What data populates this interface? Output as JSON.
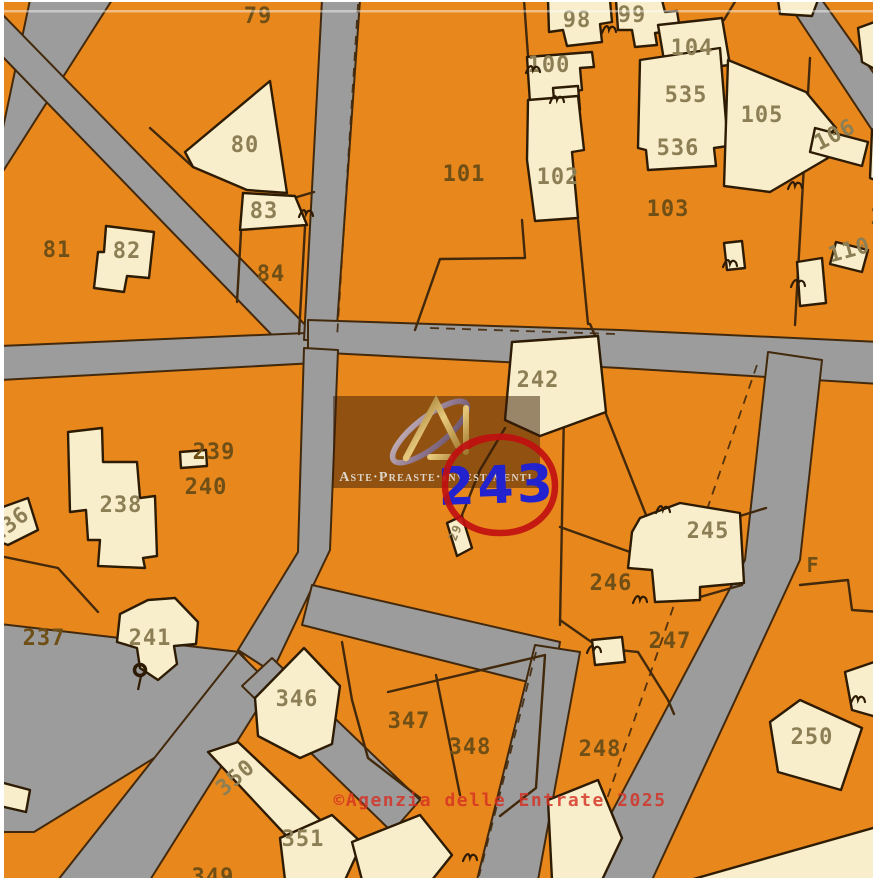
{
  "map": {
    "colors": {
      "parcel_orange": "#E8871C",
      "building_cream": "#F8EECB",
      "road_gray": "#9C9C9C",
      "outline_dark": "#43290C",
      "building_outline": "#2E1B04",
      "label_dark": "#6f4f16",
      "label_light": "#8d7f55",
      "highlight_blue": "#2222CF",
      "highlight_red": "#C01010",
      "copyright_red": "#D53022"
    },
    "watermark": {
      "brand": "Aste·Preaste·Investimenti"
    },
    "highlight": {
      "parcel": "243"
    },
    "copyright": "©Agenzia delle Entrate 2025",
    "roads": [
      {
        "id": "road-topleft-a",
        "pts": "30,0 112,0 0,176 0,142"
      },
      {
        "id": "road-topleft-b",
        "pts": "0,12 318,338 296,360 0,54"
      },
      {
        "id": "road-left-mid",
        "pts": "0,346 330,332 334,362 0,380"
      },
      {
        "id": "road-top-vertical",
        "pts": "322,0 360,0 336,340 304,340"
      },
      {
        "id": "road-central",
        "pts": "308,320 620,330 880,342 880,384 620,368 308,352"
      },
      {
        "id": "road-right-diagonal",
        "pts": "768,352 822,360 800,560 652,880 576,880 745,560"
      },
      {
        "id": "road-center-left",
        "pts": "304,348 338,350 330,550 272,672 238,650 298,552"
      },
      {
        "id": "road-west-arm",
        "pts": "0,624 240,652 268,688 34,832 0,832"
      },
      {
        "id": "road-south-arm",
        "pts": "238,652 272,686 150,880 58,880"
      },
      {
        "id": "road-southeast-arm",
        "pts": "242,686 272,658 420,800 392,832"
      },
      {
        "id": "road-bottom-mid",
        "pts": "312,585 560,642 552,688 302,625"
      },
      {
        "id": "road-bottom-vertical",
        "pts": "535,645 580,652 538,880 477,880"
      },
      {
        "id": "road-topright",
        "pts": "786,0 822,0 880,82 880,142"
      }
    ],
    "buildings": [
      {
        "id": "bldg-80",
        "pts": "270,81 287,193 247,190 193,167 185,152"
      },
      {
        "id": "bldg-83",
        "pts": "243,193 295,196 307,225 240,230"
      },
      {
        "id": "bldg-82",
        "pts": "106,226 154,232 149,278 127,276 124,292 94,288 98,252 104,252"
      },
      {
        "id": "bldg-98",
        "pts": "548,0 610,0 612,22 600,24 602,42 567,46 563,30 549,32"
      },
      {
        "id": "bldg-99",
        "pts": "616,0 662,0 665,12 677,11 680,30 655,33 657,45 635,47 632,30 618,30"
      },
      {
        "id": "bldg-100",
        "pts": "527,57 592,52 594,67 580,68 582,90 570,92 572,100 530,103"
      },
      {
        "id": "bldg-100-annex",
        "pts": "553,88 578,86 580,110 555,112"
      },
      {
        "id": "bldg-102",
        "pts": "528,100 578,96 584,150 572,152 578,218 535,221 527,160"
      },
      {
        "id": "bldg-104",
        "pts": "658,25 722,18 730,65 666,72"
      },
      {
        "id": "bldg-535",
        "pts": "640,60 720,48 728,146 714,148 716,166 648,170 646,150 638,148"
      },
      {
        "id": "bldg-105",
        "pts": "728,60 806,92 836,128 816,146 828,158 770,192 724,186"
      },
      {
        "id": "bldg-106",
        "pts": "815,128 868,142 862,166 810,152"
      },
      {
        "id": "bldg-103-small",
        "pts": "724,243 742,241 745,268 727,270"
      },
      {
        "id": "bldg-top-1",
        "pts": "778,0 818,0 812,16 780,14"
      },
      {
        "id": "bldg-top-2",
        "pts": "858,28 880,20 880,72 862,62"
      },
      {
        "id": "bldg-right-1",
        "pts": "872,130 880,126 880,182 870,178"
      },
      {
        "id": "bldg-110",
        "pts": "836,242 868,250 862,272 830,264"
      },
      {
        "id": "bldg-right-2",
        "pts": "797,262 822,258 826,303 800,306"
      },
      {
        "id": "bldg-right-3",
        "pts": "845,672 880,660 880,718 852,710"
      },
      {
        "id": "bldg-242",
        "pts": "512,342 598,336 606,412 540,436 505,420"
      },
      {
        "id": "bldg-29",
        "pts": "447,523 462,516 472,548 457,556"
      },
      {
        "id": "bldg-238",
        "pts": "68,432 102,428 103,462 137,462 140,498 155,496 157,556 143,558 145,568 98,566 100,540 88,540 86,510 70,512"
      },
      {
        "id": "bldg-239",
        "pts": "180,452 206,450 207,466 181,468"
      },
      {
        "id": "bldg-236",
        "pts": "0,508 28,498 38,530 8,545 0,542"
      },
      {
        "id": "bldg-left-sliver",
        "pts": "0,782 30,790 26,812 0,806"
      },
      {
        "id": "bldg-241",
        "pts": "120,614 148,600 175,598 198,622 196,644 174,646 177,664 158,680 140,668 137,648 117,642"
      },
      {
        "id": "bldg-346",
        "pts": "255,698 304,648 340,686 332,744 300,758 258,736"
      },
      {
        "id": "bldg-350",
        "pts": "208,752 238,742 352,850 322,874"
      },
      {
        "id": "bldg-351",
        "pts": "280,838 332,815 362,843 345,880 285,880"
      },
      {
        "id": "bldg-bottom-mid-1",
        "pts": "352,842 420,815 452,855 432,880 362,880"
      },
      {
        "id": "bldg-bottom-mid-2",
        "pts": "548,800 598,780 622,838 602,880 552,880"
      },
      {
        "id": "bldg-bottom-right",
        "pts": "690,880 880,826 880,880"
      },
      {
        "id": "bldg-245",
        "pts": "640,518 680,503 740,513 744,583 700,587 700,600 655,602 652,570 628,568 632,532"
      },
      {
        "id": "bldg-247-annex",
        "pts": "592,640 622,637 625,662 595,665"
      },
      {
        "id": "bldg-250",
        "pts": "770,722 800,700 862,728 841,790 778,772"
      }
    ],
    "boundaries": [
      {
        "pts": "193,167 150,128"
      },
      {
        "pts": "297,197 314,192"
      },
      {
        "pts": "241,232 237,302"
      },
      {
        "pts": "305,227 299,334"
      },
      {
        "pts": "524,0 528,56"
      },
      {
        "pts": "522,220 525,258 440,259 415,330"
      },
      {
        "pts": "578,220 588,324"
      },
      {
        "pts": "810,58 795,325"
      },
      {
        "pts": "660,26 654,0"
      },
      {
        "pts": "724,20 736,0"
      },
      {
        "pts": "646,148 714,146"
      },
      {
        "pts": "0,556 58,568 98,612"
      },
      {
        "pts": "565,358 560,625"
      },
      {
        "pts": "560,527 630,552"
      },
      {
        "pts": "606,414 648,520"
      },
      {
        "pts": "560,620 600,648 638,652 668,700 674,714"
      },
      {
        "pts": "505,428 480,470 462,515"
      },
      {
        "pts": "597,340 590,324"
      },
      {
        "pts": "740,516 766,508"
      },
      {
        "pts": "700,597 742,585"
      },
      {
        "pts": "800,585 848,580 852,610 880,612"
      },
      {
        "pts": "436,675 460,795"
      },
      {
        "pts": "342,642 352,700 368,758 420,798"
      },
      {
        "pts": "388,692 545,655 536,788 500,816"
      }
    ],
    "dashed_lines": [
      {
        "pts": "358,4 337,338"
      },
      {
        "pts": "430,328 616,334"
      },
      {
        "pts": "757,365 581,874"
      },
      {
        "pts": "536,652 479,876"
      }
    ],
    "parcel_labels": [
      {
        "text": "79",
        "x": 258,
        "y": 23,
        "tone": "dark"
      },
      {
        "text": "80",
        "x": 245,
        "y": 152,
        "tone": "light"
      },
      {
        "text": "81",
        "x": 57,
        "y": 257,
        "tone": "dark"
      },
      {
        "text": "82",
        "x": 127,
        "y": 258,
        "tone": "light"
      },
      {
        "text": "83",
        "x": 264,
        "y": 218,
        "tone": "light"
      },
      {
        "text": "84",
        "x": 271,
        "y": 281,
        "tone": "dark"
      },
      {
        "text": "98",
        "x": 577,
        "y": 27,
        "tone": "light"
      },
      {
        "text": "99",
        "x": 632,
        "y": 22,
        "tone": "light"
      },
      {
        "text": "100",
        "x": 549,
        "y": 72,
        "tone": "light"
      },
      {
        "text": "101",
        "x": 464,
        "y": 181,
        "tone": "dark"
      },
      {
        "text": "102",
        "x": 558,
        "y": 184,
        "tone": "light"
      },
      {
        "text": "103",
        "x": 668,
        "y": 216,
        "tone": "dark"
      },
      {
        "text": "104",
        "x": 692,
        "y": 55,
        "tone": "light"
      },
      {
        "text": "105",
        "x": 762,
        "y": 122,
        "tone": "light"
      },
      {
        "text": "106",
        "x": 838,
        "y": 141,
        "tone": "light",
        "rot": -27
      },
      {
        "text": "110",
        "x": 851,
        "y": 257,
        "tone": "light",
        "rot": -15
      },
      {
        "text": "1",
        "x": 877,
        "y": 224,
        "tone": "dark"
      },
      {
        "text": "535",
        "x": 686,
        "y": 102,
        "tone": "light"
      },
      {
        "text": "536",
        "x": 678,
        "y": 155,
        "tone": "light"
      },
      {
        "text": "236",
        "x": 14,
        "y": 530,
        "tone": "light",
        "rot": -38
      },
      {
        "text": "237",
        "x": 44,
        "y": 645,
        "tone": "dark"
      },
      {
        "text": "238",
        "x": 121,
        "y": 512,
        "tone": "light"
      },
      {
        "text": "239",
        "x": 214,
        "y": 459,
        "tone": "dark"
      },
      {
        "text": "240",
        "x": 206,
        "y": 494,
        "tone": "dark"
      },
      {
        "text": "241",
        "x": 150,
        "y": 645,
        "tone": "light"
      },
      {
        "text": "242",
        "x": 538,
        "y": 387,
        "tone": "light"
      },
      {
        "text": "245",
        "x": 708,
        "y": 538,
        "tone": "light"
      },
      {
        "text": "246",
        "x": 611,
        "y": 590,
        "tone": "dark"
      },
      {
        "text": "247",
        "x": 670,
        "y": 648,
        "tone": "dark"
      },
      {
        "text": "248",
        "x": 600,
        "y": 756,
        "tone": "dark"
      },
      {
        "text": "250",
        "x": 812,
        "y": 744,
        "tone": "light"
      },
      {
        "text": "346",
        "x": 297,
        "y": 706,
        "tone": "light"
      },
      {
        "text": "347",
        "x": 409,
        "y": 728,
        "tone": "dark"
      },
      {
        "text": "348",
        "x": 470,
        "y": 754,
        "tone": "dark"
      },
      {
        "text": "349",
        "x": 213,
        "y": 884,
        "tone": "dark"
      },
      {
        "text": "350",
        "x": 240,
        "y": 783,
        "tone": "light",
        "rot": -40
      },
      {
        "text": "351",
        "x": 303,
        "y": 846,
        "tone": "light"
      },
      {
        "text": "F",
        "x": 813,
        "y": 572,
        "tone": "dark",
        "size": 20
      },
      {
        "text": "29",
        "x": 459,
        "y": 534,
        "tone": "light",
        "rot": -68,
        "size": 12
      }
    ],
    "survey_marks": [
      {
        "x": 609,
        "y": 30
      },
      {
        "x": 533,
        "y": 70
      },
      {
        "x": 557,
        "y": 100
      },
      {
        "x": 795,
        "y": 186
      },
      {
        "x": 730,
        "y": 264
      },
      {
        "x": 798,
        "y": 284
      },
      {
        "x": 663,
        "y": 510
      },
      {
        "x": 640,
        "y": 600
      },
      {
        "x": 594,
        "y": 650
      },
      {
        "x": 470,
        "y": 858
      },
      {
        "x": 306,
        "y": 214
      },
      {
        "x": 858,
        "y": 700
      }
    ],
    "circle_mark": {
      "x": 140,
      "y": 670
    }
  }
}
